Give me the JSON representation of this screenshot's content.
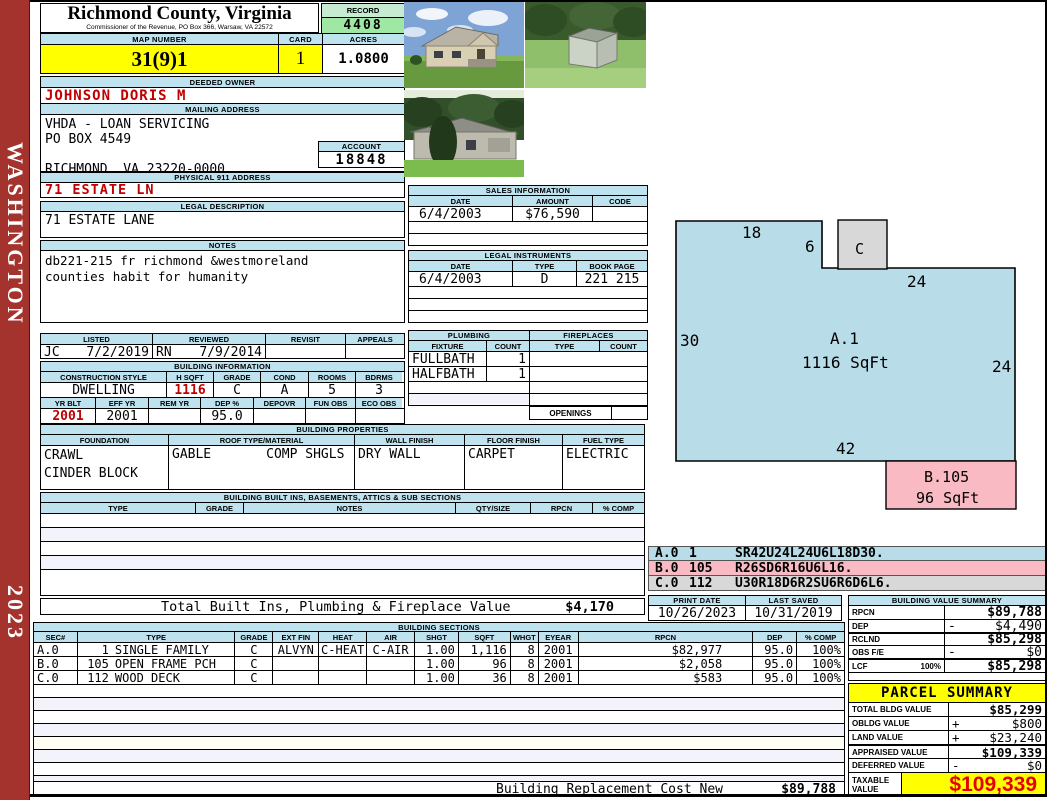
{
  "sidebar": {
    "county_name": "WASHINGTON",
    "year": "2023"
  },
  "header": {
    "county_title": "Richmond County, Virginia",
    "commissioner_line": "Commissioner of the Revenue, PO Box 366, Warsaw, VA 22572",
    "record_label": "RECORD",
    "record_value": "4408",
    "map_number_label": "MAP NUMBER",
    "map_number": "31(9)1",
    "card_label": "CARD",
    "card": "1",
    "acres_label": "ACRES",
    "acres": "1.0800"
  },
  "owner": {
    "label": "DEEDED OWNER",
    "name": "JOHNSON DORIS M"
  },
  "mailing": {
    "label": "MAILING ADDRESS",
    "line1": "VHDA - LOAN SERVICING",
    "line2": "PO BOX 4549",
    "line3": "RICHMOND, VA 23220-0000"
  },
  "account": {
    "label": "ACCOUNT",
    "value": "18848"
  },
  "physical": {
    "label": "PHYSICAL 911 ADDRESS",
    "value": "71 ESTATE LN"
  },
  "legal": {
    "label": "LEGAL DESCRIPTION",
    "value": "71 ESTATE LANE"
  },
  "notes": {
    "label": "NOTES",
    "line1": "db221-215 fr richmond &westmoreland",
    "line2": "counties habit for humanity"
  },
  "review": {
    "listed_label": "LISTED",
    "reviewed_label": "REVIEWED",
    "revisit_label": "REVISIT",
    "appeals_label": "APPEALS",
    "listed_by": "JC",
    "listed_date": "7/2/2019",
    "reviewed_by": "RN",
    "reviewed_date": "7/9/2014"
  },
  "building_information": {
    "label": "BUILDING INFORMATION",
    "h1": [
      "CONSTRUCTION STYLE",
      "H SQFT",
      "GRADE",
      "COND",
      "ROOMS",
      "BDRMS"
    ],
    "style": "DWELLING",
    "hsqft": "1116",
    "grade": "C",
    "cond": "A",
    "rooms": "5",
    "bdrms": "3",
    "h2": [
      "YR BLT",
      "EFF YR",
      "REM YR",
      "DEP %",
      "DEPOVR",
      "FUN OBS",
      "ECO OBS"
    ],
    "yr_blt": "2001",
    "eff_yr": "2001",
    "rem_yr": "",
    "dep_pct": "95.0",
    "depovr": "",
    "fun_obs": "",
    "eco_obs": ""
  },
  "sales": {
    "label": "SALES INFORMATION",
    "h": [
      "DATE",
      "AMOUNT",
      "CODE"
    ],
    "date": "6/4/2003",
    "amount": "$76,590",
    "code": ""
  },
  "instruments": {
    "label": "LEGAL INSTRUMENTS",
    "h": [
      "DATE",
      "TYPE",
      "BOOK PAGE"
    ],
    "date": "6/4/2003",
    "type": "D",
    "bookpage": "221 215"
  },
  "plumbing": {
    "label": "PLUMBING",
    "h": [
      "FIXTURE",
      "COUNT"
    ],
    "rows": [
      {
        "fixture": "FULLBATH",
        "count": "1"
      },
      {
        "fixture": "HALFBATH",
        "count": "1"
      }
    ]
  },
  "fireplaces": {
    "label": "FIREPLACES",
    "h": [
      "TYPE",
      "COUNT"
    ],
    "openings_label": "OPENINGS"
  },
  "building_properties": {
    "label": "BUILDING PROPERTIES",
    "h": [
      "FOUNDATION",
      "ROOF TYPE/MATERIAL",
      "WALL FINISH",
      "FLOOR FINISH",
      "FUEL TYPE"
    ],
    "foundation1": "CRAWL",
    "foundation2": "CINDER BLOCK",
    "roof_type": "GABLE",
    "roof_material": "COMP SHGLS",
    "wall_finish": "DRY WALL",
    "floor_finish": "CARPET",
    "fuel_type": "ELECTRIC"
  },
  "built_ins": {
    "label": "BUILDING BUILT INS, BASEMENTS, ATTICS & SUB SECTIONS",
    "h": [
      "TYPE",
      "GRADE",
      "NOTES",
      "QTY/SIZE",
      "RPCN",
      "% COMP"
    ],
    "total_label": "Total Built Ins, Plumbing & Fireplace Value",
    "total_value": "$4,170"
  },
  "sketch": {
    "area_a_code": "A.1",
    "area_a_size": "1116 SqFt",
    "area_b_code": "B.105",
    "area_b_size": "96 SqFt",
    "area_c_code": "C",
    "dim_top_left": "18",
    "dim_notch": "6",
    "dim_top_right": "24",
    "dim_left": "30",
    "dim_right": "24",
    "dim_bottom": "42",
    "legend": [
      {
        "code": "A.0",
        "value": "1",
        "path": "SR42U24L24U6L18D30."
      },
      {
        "code": "B.0",
        "value": "105",
        "path": "R26SD6R16U6L16."
      },
      {
        "code": "C.0",
        "value": "112",
        "path": "U30R18D6R2SU6R6D6L6."
      }
    ]
  },
  "print_info": {
    "print_date_label": "PRINT DATE",
    "print_date": "10/26/2023",
    "last_saved_label": "LAST SAVED",
    "last_saved": "10/31/2019"
  },
  "building_value_summary": {
    "label": "BUILDING VALUE SUMMARY",
    "rows": [
      {
        "label": "RPCN",
        "op": "",
        "value": "$89,788"
      },
      {
        "label": "DEP",
        "op": "-",
        "value": "$4,490"
      },
      {
        "label": "RCLND",
        "op": "",
        "value": "$85,298"
      },
      {
        "label": "OBS F/E",
        "op": "-",
        "value": "$0"
      },
      {
        "label": "LCF",
        "pct": "100%",
        "op": "",
        "value": "$85,298"
      }
    ]
  },
  "building_sections": {
    "label": "BUILDING SECTIONS",
    "h": [
      "SEC#",
      "TYPE",
      "GRADE",
      "EXT FIN",
      "HEAT",
      "AIR",
      "SHGT",
      "SQFT",
      "WHGT",
      "EYEAR",
      "RPCN",
      "DEP",
      "% COMP"
    ],
    "rows": [
      {
        "sec": "A.0",
        "num": "1",
        "type": "SINGLE FAMILY",
        "grade": "C",
        "extfin": "ALVYN",
        "heat": "C-HEAT",
        "air": "C-AIR",
        "shgt": "1.00",
        "sqft": "1,116",
        "whgt": "8",
        "eyear": "2001",
        "rpcn": "$82,977",
        "dep": "95.0",
        "comp": "100%"
      },
      {
        "sec": "B.0",
        "num": "105",
        "type": "OPEN FRAME PCH",
        "grade": "C",
        "extfin": "",
        "heat": "",
        "air": "",
        "shgt": "1.00",
        "sqft": "96",
        "whgt": "8",
        "eyear": "2001",
        "rpcn": "$2,058",
        "dep": "95.0",
        "comp": "100%"
      },
      {
        "sec": "C.0",
        "num": "112",
        "type": "WOOD DECK",
        "grade": "C",
        "extfin": "",
        "heat": "",
        "air": "",
        "shgt": "1.00",
        "sqft": "36",
        "whgt": "8",
        "eyear": "2001",
        "rpcn": "$583",
        "dep": "95.0",
        "comp": "100%"
      }
    ],
    "replacement_label": "Building Replacement Cost New",
    "replacement_value": "$89,788"
  },
  "parcel_summary": {
    "label": "PARCEL SUMMARY",
    "rows": [
      {
        "label": "TOTAL BLDG VALUE",
        "op": "",
        "value": "$85,299"
      },
      {
        "label": "OBLDG VALUE",
        "op": "+",
        "value": "$800"
      },
      {
        "label": "LAND VALUE",
        "op": "+",
        "value": "$23,240"
      },
      {
        "label": "APPRAISED VALUE",
        "op": "",
        "value": "$109,339"
      },
      {
        "label": "DEFERRED VALUE",
        "op": "-",
        "value": "$0"
      }
    ],
    "taxable_label1": "TAXABLE",
    "taxable_label2": "VALUE",
    "taxable_value": "$109,339"
  },
  "colors": {
    "band_blue": "#BEE2EE",
    "record_green": "#9FE8A4",
    "highlight_yellow": "#FFFF00",
    "alert_red": "#C00000",
    "taxable_red": "#E60000",
    "sidebar_red": "#A4322D",
    "sketch_blue": "#B8DCE8",
    "sketch_pink": "#F9BAC3",
    "sketch_gray": "#D8D8D8"
  }
}
